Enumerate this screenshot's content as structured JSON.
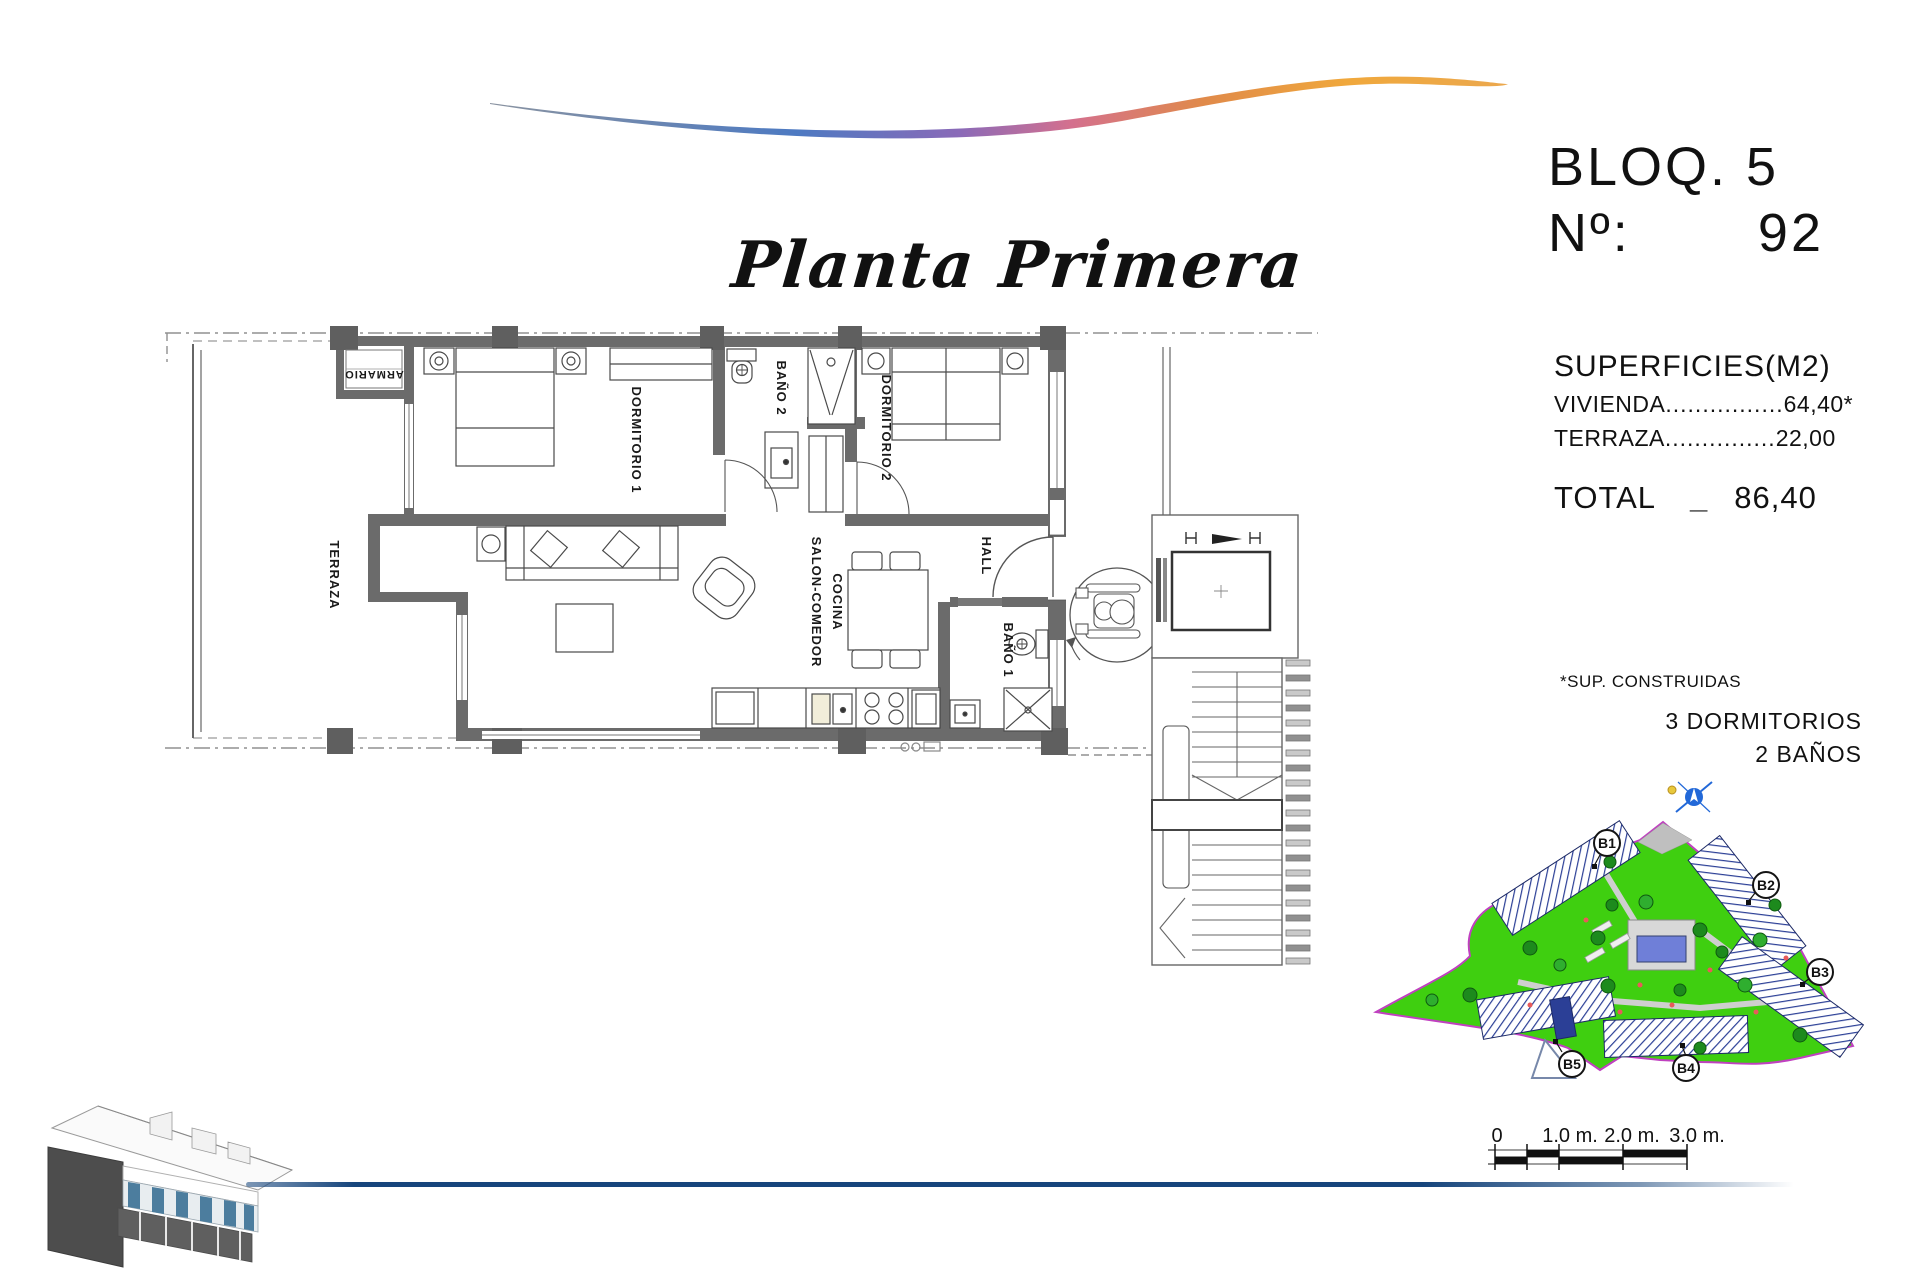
{
  "header": {
    "title": "Planta Primera",
    "block_label": "BLOQ. 5",
    "number_label": "Nº:",
    "number_value": "92"
  },
  "surfaces": {
    "heading": "SUPERFICIES(M2)",
    "rows": [
      {
        "label": "VIVIENDA",
        "dots": "................",
        "value": "64,40*"
      },
      {
        "label": "TERRAZA",
        "dots": "...............",
        "value": "22,00"
      }
    ],
    "total_label": "TOTAL",
    "total_separator": "_",
    "total_value": "86,40"
  },
  "notes": {
    "footnote": "*SUP. CONSTRUIDAS",
    "bedrooms": "3 DORMITORIOS",
    "bathrooms": "2 BAÑOS"
  },
  "floorplan": {
    "labels": {
      "terraza": "TERRAZA",
      "armario": "ARMARIO",
      "dormitorio1": "DORMITORIO 1",
      "bano2": "BAÑO 2",
      "dormitorio2": "DORMITORIO 2",
      "salon_line1": "SALON-COMEDOR",
      "salon_line2": "COCINA",
      "hall": "HALL",
      "bano1": "BAÑO 1"
    }
  },
  "siteplan": {
    "block_markers": {
      "b1": "B1",
      "b2": "B2",
      "b3": "B3",
      "b4": "B4",
      "b5": "B5"
    },
    "colors": {
      "grass": "#3fcf10",
      "boundary": "#c040c0",
      "building_hatch": "#2b3f96",
      "tree": "#1d8a1d",
      "pool_water": "#6f7fd8"
    }
  },
  "scalebar": {
    "ticks": {
      "t0": "0",
      "t1": "1.0 m.",
      "t2": "2.0 m.",
      "t3": "3.0 m."
    }
  },
  "decor": {
    "swoosh_colors": [
      "#8a93a0",
      "#4d7ac2",
      "#8a6ab8",
      "#d4708e",
      "#e08a4a",
      "#f0a83c"
    ],
    "baseline_color": "#16457c"
  }
}
